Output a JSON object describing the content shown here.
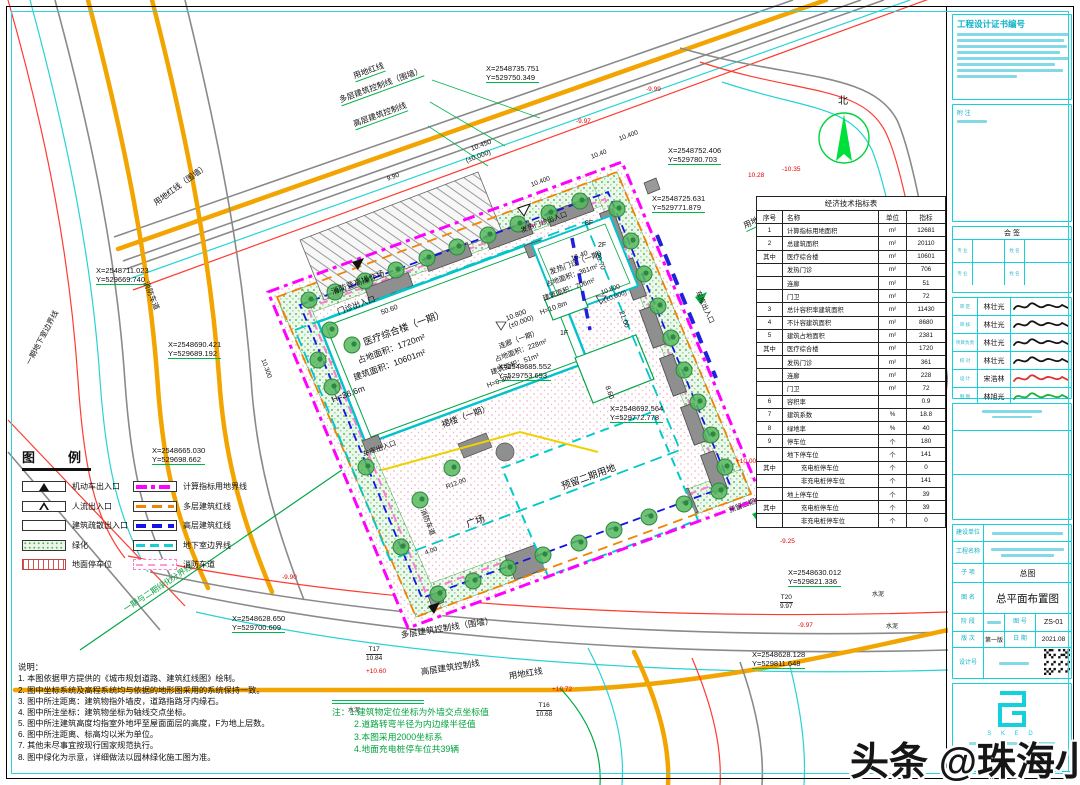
{
  "watermark": {
    "text": "头条 @珠海小凡"
  },
  "legend": {
    "title": "图　例",
    "left": [
      {
        "name": "机动车出入口",
        "swatch": "motor"
      },
      {
        "name": "人流出入口",
        "swatch": "pedestrian"
      },
      {
        "name": "建筑疏散出入口",
        "swatch": "evac"
      },
      {
        "name": "绿化",
        "swatch": "green"
      },
      {
        "name": "地面停车位",
        "swatch": "parking"
      }
    ],
    "right": [
      {
        "name": "计算指标用地界线",
        "swatch": "mag"
      },
      {
        "name": "多层建筑红线",
        "swatch": "org"
      },
      {
        "name": "高层建筑红线",
        "swatch": "blu"
      },
      {
        "name": "地下室边界线",
        "swatch": "cyn"
      },
      {
        "name": "消防车道",
        "swatch": "fire"
      }
    ]
  },
  "eco_table": {
    "title": "经济技术指标表",
    "headers": [
      "序号",
      "名称",
      "单位",
      "指标"
    ],
    "rows": [
      [
        "1",
        "计算指标用地面积",
        "m²",
        "12681"
      ],
      [
        "2",
        "总建筑面积",
        "m²",
        "20110"
      ],
      [
        "其中",
        "医疗综合楼",
        "m²",
        "10601"
      ],
      [
        "",
        "发热门诊",
        "m²",
        "706"
      ],
      [
        "",
        "连廊",
        "m²",
        "51"
      ],
      [
        "",
        "门卫",
        "m²",
        "72"
      ],
      [
        "3",
        "总计容积率建筑面积",
        "m²",
        "11430"
      ],
      [
        "4",
        "不计容建筑面积",
        "m²",
        "8680"
      ],
      [
        "5",
        "建筑占地面积",
        "m²",
        "2381"
      ],
      [
        "其中",
        "医疗综合楼",
        "m²",
        "1720"
      ],
      [
        "",
        "发热门诊",
        "m²",
        "361"
      ],
      [
        "",
        "连廊",
        "m²",
        "228"
      ],
      [
        "",
        "门卫",
        "m²",
        "72"
      ],
      [
        "6",
        "容积率",
        "",
        "0.9"
      ],
      [
        "7",
        "建筑系数",
        "%",
        "18.8"
      ],
      [
        "8",
        "绿地率",
        "%",
        "40"
      ],
      [
        "9",
        "停车位",
        "个",
        "180"
      ],
      [
        "",
        "地下停车位",
        "个",
        "141"
      ],
      [
        "其中",
        "充电桩停车位",
        "个",
        "0",
        1
      ],
      [
        "",
        "非充电桩停车位",
        "个",
        "141",
        1
      ],
      [
        "",
        "地上停车位",
        "个",
        "39"
      ],
      [
        "其中",
        "充电桩停车位",
        "个",
        "39",
        1
      ],
      [
        "",
        "非充电桩停车位",
        "个",
        "0",
        1
      ]
    ]
  },
  "notes": {
    "title": "说明：",
    "items": [
      "1. 本图依据甲方提供的《城市规划道路、建筑红线图》绘制。",
      "2. 图中坐标系统及高程系统均与依据的地形图采用的系统保持一致。",
      "3. 图中所注距离：建筑物指外墙皮，道路指路牙内缘石。",
      "4. 图中所注坐标：建筑物坐标为轴线交点坐标。",
      "5. 图中所注建筑高度均指室外地坪至屋面面层的高度，F为地上层数。",
      "6. 图中所注距离、标高均以米为单位。",
      "7. 其他未尽事宜按现行国家规范执行。",
      "8. 图中绿化为示意，详细做法以园林绿化施工图为准。"
    ]
  },
  "plan_notes": {
    "lines": [
      "注：1.建筑物定位坐标为外墙交点坐标值",
      "2.道路转弯半径为内边缘半径值",
      "3.本图采用2000坐标系",
      "4.地面充电桩停车位共39辆"
    ]
  },
  "plan_labels": [
    {
      "t": "用地红线",
      "x": 352,
      "y": 72,
      "r": -20,
      "s": 8,
      "lead": 1
    },
    {
      "t": "多层建筑控制线（围墙）",
      "x": 338,
      "y": 96,
      "r": -20,
      "s": 8,
      "lead": 1
    },
    {
      "t": "高层建筑控制线",
      "x": 352,
      "y": 120,
      "r": -20,
      "s": 8,
      "lead": 1
    },
    {
      "t": "X=2548735.751\nY=529750.349",
      "x": 486,
      "y": 64,
      "r": 0,
      "s": 7.5,
      "lead": 1
    },
    {
      "t": "X=2548752.406\nY=529780.703",
      "x": 668,
      "y": 146,
      "r": 0,
      "s": 7.5,
      "lead": 1
    },
    {
      "t": "X=2548725.631\nY=529771.879",
      "x": 652,
      "y": 194,
      "r": 0,
      "s": 7.5,
      "lead": 1
    },
    {
      "t": "用地红线（围墙）",
      "x": 742,
      "y": 222,
      "r": -25,
      "s": 8,
      "lead": 1
    },
    {
      "t": "多层建筑控制线",
      "x": 754,
      "y": 256,
      "r": -25,
      "s": 8,
      "lead": 1
    },
    {
      "t": "高层建筑控制线",
      "x": 764,
      "y": 292,
      "r": -25,
      "s": 8,
      "lead": 1
    },
    {
      "t": "车库出入口",
      "x": 700,
      "y": 290,
      "r": 65,
      "s": 7
    },
    {
      "t": "预留二期车库出入口",
      "x": 728,
      "y": 508,
      "r": -20,
      "s": 7
    },
    {
      "t": "X=2548630.012\nY=529821.336",
      "x": 788,
      "y": 568,
      "r": 0,
      "s": 7.5,
      "lead": 1
    },
    {
      "t": "X=2548628.128\nY=529811.648",
      "x": 752,
      "y": 650,
      "r": 0,
      "s": 7.5,
      "lead": 1
    },
    {
      "t": "多层建筑控制线（围墙）",
      "x": 400,
      "y": 630,
      "r": -9,
      "s": 8.5
    },
    {
      "t": "高层建筑控制线",
      "x": 420,
      "y": 667,
      "r": -9,
      "s": 8.5
    },
    {
      "t": "用地红线",
      "x": 508,
      "y": 671,
      "r": -9,
      "s": 8.5
    },
    {
      "t": "X=2548711.023\nY=529669.740",
      "x": 96,
      "y": 266,
      "r": 0,
      "s": 7.5,
      "lead": 1
    },
    {
      "t": "X=2548690.421\nY=529689.192",
      "x": 168,
      "y": 340,
      "r": 0,
      "s": 7.5,
      "lead": 1
    },
    {
      "t": "X=2548665.030\nY=529698.662",
      "x": 152,
      "y": 446,
      "r": 0,
      "s": 7.5,
      "lead": 1
    },
    {
      "t": "X=2548628.650\nY=529700.609",
      "x": 232,
      "y": 614,
      "r": 0,
      "s": 7.5,
      "lead": 1
    },
    {
      "t": "一期地下室边界线",
      "x": 24,
      "y": 362,
      "r": -62,
      "s": 7.5
    },
    {
      "t": "消防车道",
      "x": 150,
      "y": 280,
      "r": 68,
      "s": 7.5
    },
    {
      "t": "用地红线（围墙）",
      "x": 152,
      "y": 200,
      "r": -36,
      "s": 8
    },
    {
      "t": "一期与二期绿化分界线",
      "x": 122,
      "y": 606,
      "r": -33,
      "s": 8,
      "c": "#00a040"
    },
    {
      "t": "医疗综合楼（一期）",
      "x": 362,
      "y": 338,
      "r": -20,
      "s": 9.5
    },
    {
      "t": "占地面积：1720m²",
      "x": 356,
      "y": 356,
      "r": -20,
      "s": 8.5
    },
    {
      "t": "建筑面积：10601m²",
      "x": 352,
      "y": 373,
      "r": -20,
      "s": 8.5
    },
    {
      "t": "H=36.6m",
      "x": 330,
      "y": 395,
      "r": -20,
      "s": 8.5
    },
    {
      "t": "10.800\n(±0.000)",
      "x": 505,
      "y": 316,
      "r": -20,
      "s": 7
    },
    {
      "t": "X=2548685.552\nY=529753.693",
      "x": 498,
      "y": 362,
      "r": 0,
      "s": 7.5,
      "lead": 1
    },
    {
      "t": "裙楼（一期）",
      "x": 440,
      "y": 420,
      "r": -20,
      "s": 8.5
    },
    {
      "t": "50.60",
      "x": 380,
      "y": 310,
      "r": -20,
      "s": 7
    },
    {
      "t": "20.70",
      "x": 600,
      "y": 252,
      "r": 70,
      "s": 7
    },
    {
      "t": "8.60",
      "x": 610,
      "y": 385,
      "r": 70,
      "s": 7
    },
    {
      "t": "发热门诊（一期）",
      "x": 548,
      "y": 268,
      "r": -20,
      "s": 7.5
    },
    {
      "t": "占地面积：361m²",
      "x": 545,
      "y": 282,
      "r": -20,
      "s": 7
    },
    {
      "t": "建筑面积：706m²",
      "x": 542,
      "y": 296,
      "r": -20,
      "s": 7
    },
    {
      "t": "H=10.8m",
      "x": 539,
      "y": 310,
      "r": -20,
      "s": 7
    },
    {
      "t": "10.800\n(±0.000)",
      "x": 600,
      "y": 290,
      "r": -20,
      "s": 6.5
    },
    {
      "t": "2F",
      "x": 598,
      "y": 242,
      "r": 0,
      "s": 7
    },
    {
      "t": "16.40",
      "x": 570,
      "y": 256,
      "r": -20,
      "s": 7
    },
    {
      "t": "连廊（一期）",
      "x": 498,
      "y": 344,
      "r": -20,
      "s": 7
    },
    {
      "t": "占地面积：228m²",
      "x": 494,
      "y": 357,
      "r": -20,
      "s": 7
    },
    {
      "t": "建筑面积：51m²",
      "x": 490,
      "y": 370,
      "r": -20,
      "s": 7
    },
    {
      "t": "H=6.3m",
      "x": 486,
      "y": 383,
      "r": -20,
      "s": 7
    },
    {
      "t": "1F",
      "x": 560,
      "y": 330,
      "r": 0,
      "s": 7
    },
    {
      "t": "8F",
      "x": 585,
      "y": 220,
      "r": 0,
      "s": 7
    },
    {
      "t": "发热门诊出入口",
      "x": 520,
      "y": 228,
      "r": -20,
      "s": 7
    },
    {
      "t": "消防登高操作场",
      "x": 330,
      "y": 288,
      "r": -20,
      "s": 8
    },
    {
      "t": "门诊出入口",
      "x": 336,
      "y": 308,
      "r": -20,
      "s": 8
    },
    {
      "t": "预留二期用地",
      "x": 560,
      "y": 482,
      "r": -20,
      "s": 9.5
    },
    {
      "t": "广场",
      "x": 465,
      "y": 520,
      "r": -20,
      "s": 9.5
    },
    {
      "t": "X=2548692.564\nY=529772.778",
      "x": 610,
      "y": 404,
      "r": 0,
      "s": 7.5,
      "lead": 1
    },
    {
      "t": "R12.00",
      "x": 445,
      "y": 484,
      "r": -20,
      "s": 6.5
    },
    {
      "t": "消防车道",
      "x": 425,
      "y": 508,
      "r": 68,
      "s": 7
    },
    {
      "t": "车库出入口",
      "x": 362,
      "y": 452,
      "r": -20,
      "s": 7
    },
    {
      "t": "T17\n10.84",
      "x": 366,
      "y": 646,
      "r": 0,
      "s": 6.5,
      "frac": 1
    },
    {
      "t": "T16\n10.68",
      "x": 536,
      "y": 702,
      "r": 0,
      "s": 6.5,
      "frac": 1
    },
    {
      "t": "T20\n9.97",
      "x": 780,
      "y": 594,
      "r": 0,
      "s": 6.5,
      "frac": 1
    },
    {
      "t": "水泥",
      "x": 348,
      "y": 708,
      "r": 0,
      "s": 6
    },
    {
      "t": "水泥",
      "x": 872,
      "y": 592,
      "r": 0,
      "s": 6
    },
    {
      "t": "水泥",
      "x": 886,
      "y": 624,
      "r": 0,
      "s": 6
    },
    {
      "t": "-9.99",
      "x": 646,
      "y": 86,
      "r": 0,
      "s": 6.5,
      "c": "#e60000"
    },
    {
      "t": "-9.97",
      "x": 576,
      "y": 118,
      "r": 0,
      "s": 6.5,
      "c": "#e60000"
    },
    {
      "t": "10.28",
      "x": 748,
      "y": 172,
      "r": 0,
      "s": 6.5,
      "c": "#e60000"
    },
    {
      "t": "-10.35",
      "x": 782,
      "y": 166,
      "r": 0,
      "s": 6.5,
      "c": "#e60000"
    },
    {
      "t": "+10.00",
      "x": 736,
      "y": 458,
      "r": 0,
      "s": 6.5,
      "c": "#e60000"
    },
    {
      "t": "-9.25",
      "x": 780,
      "y": 538,
      "r": 0,
      "s": 6.5,
      "c": "#e60000"
    },
    {
      "t": "-9.97",
      "x": 798,
      "y": 622,
      "r": 0,
      "s": 6.5,
      "c": "#e60000"
    },
    {
      "t": "+10.60",
      "x": 366,
      "y": 668,
      "r": 0,
      "s": 6.5,
      "c": "#e60000"
    },
    {
      "t": "+10.72",
      "x": 552,
      "y": 686,
      "r": 0,
      "s": 6.5,
      "c": "#e60000"
    },
    {
      "t": "-9.90",
      "x": 282,
      "y": 574,
      "r": 0,
      "s": 6.5,
      "c": "#e60000"
    },
    {
      "t": "10.450",
      "x": 470,
      "y": 146,
      "r": -20,
      "s": 7
    },
    {
      "t": "(±0.000)",
      "x": 465,
      "y": 158,
      "r": -20,
      "s": 7
    },
    {
      "t": "10.40",
      "x": 590,
      "y": 154,
      "r": -20,
      "s": 6.5
    },
    {
      "t": "10.400",
      "x": 530,
      "y": 182,
      "r": -20,
      "s": 6.5
    },
    {
      "t": "9.90",
      "x": 386,
      "y": 176,
      "r": -20,
      "s": 6.5
    },
    {
      "t": "10.400",
      "x": 618,
      "y": 136,
      "r": -20,
      "s": 6.5
    },
    {
      "t": "10.300",
      "x": 266,
      "y": 358,
      "r": 70,
      "s": 6.5
    },
    {
      "t": "21.00",
      "x": 624,
      "y": 310,
      "r": 70,
      "s": 7
    },
    {
      "t": "4.00",
      "x": 424,
      "y": 550,
      "r": -20,
      "s": 6.5
    },
    {
      "t": "北",
      "x": 838,
      "y": 96,
      "r": 0,
      "s": 10
    }
  ],
  "title_block": {
    "cert_title": "工程设计证书编号",
    "note_label": "附 注",
    "countersign": {
      "label": "会 签",
      "col_labels": [
        "专 业",
        "姓 名"
      ]
    },
    "sign_rows": [
      {
        "role": "审 定",
        "name": "林壮光",
        "sig": "black"
      },
      {
        "role": "审 核",
        "name": "林壮光",
        "sig": "black"
      },
      {
        "role": "项目负责",
        "name": "林壮光",
        "sig": "black"
      },
      {
        "role": "校 对",
        "name": "林壮光",
        "sig": "black"
      },
      {
        "role": "设 计",
        "name": "宋浩林",
        "sig": "red"
      },
      {
        "role": "制 图",
        "name": "林旭光",
        "sig": "green"
      }
    ],
    "owner_label": "建设单位",
    "project_label": "工程名称",
    "sub_label": "子 项",
    "sub_value": "总图",
    "name_label": "图 名",
    "name_value": "总平面布置图",
    "stage_label": "阶 段",
    "sheet_label": "图 号",
    "sheet_value": "ZS-01",
    "ver_label": "版 次",
    "ver_value": "第一版",
    "date_label": "日 期",
    "date_value": "2021.08",
    "design_label": "设计号",
    "logo_letters": "S K E D"
  }
}
